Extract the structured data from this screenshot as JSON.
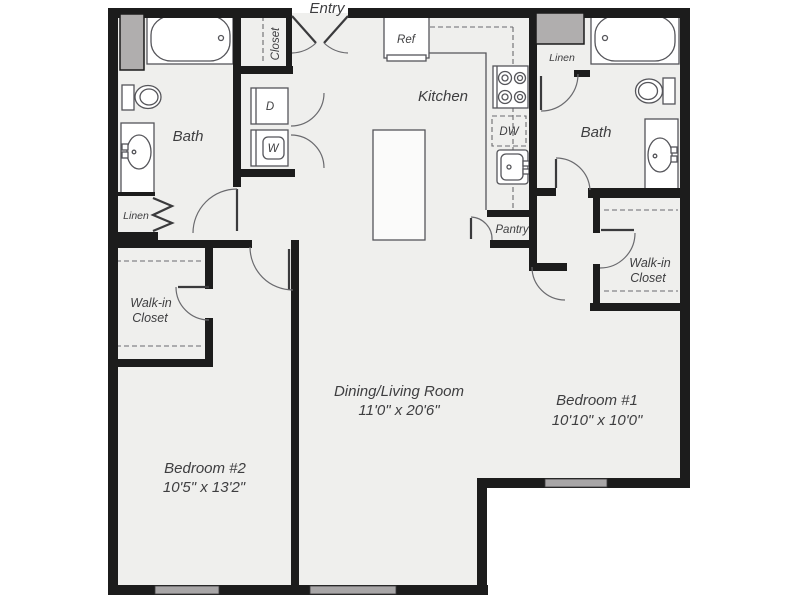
{
  "floor_plan": {
    "entry": {
      "label": "Entry"
    },
    "entry_closet": {
      "label": "Closet"
    },
    "laundry": {
      "dryer": "D",
      "washer": "W"
    },
    "kitchen": {
      "label": "Kitchen",
      "refrigerator": "Ref",
      "dishwasher": "DW",
      "pantry": "Pantry"
    },
    "bath_left": {
      "label": "Bath",
      "linen": "Linen"
    },
    "bath_right": {
      "label": "Bath",
      "linen": "Linen"
    },
    "walk_in_closet_left": {
      "line1": "Walk-in",
      "line2": "Closet"
    },
    "walk_in_closet_right": {
      "line1": "Walk-in",
      "line2": "Closet"
    },
    "dining_living_room": {
      "name": "Dining/Living Room",
      "dimensions": "11'0\" x 20'6\""
    },
    "bedroom_1": {
      "name": "Bedroom #1",
      "dimensions": "10'10\" x 10'0\""
    },
    "bedroom_2": {
      "name": "Bedroom #2",
      "dimensions": "10'5\" x 13'2\""
    }
  },
  "colors": {
    "wall": "#1c1c1c",
    "floor": "#efefed",
    "fixture_outline": "#55555a",
    "window_fill": "#a8a6a7",
    "shaft_fill": "#b0aeae",
    "label_text": "#3e3e40"
  }
}
